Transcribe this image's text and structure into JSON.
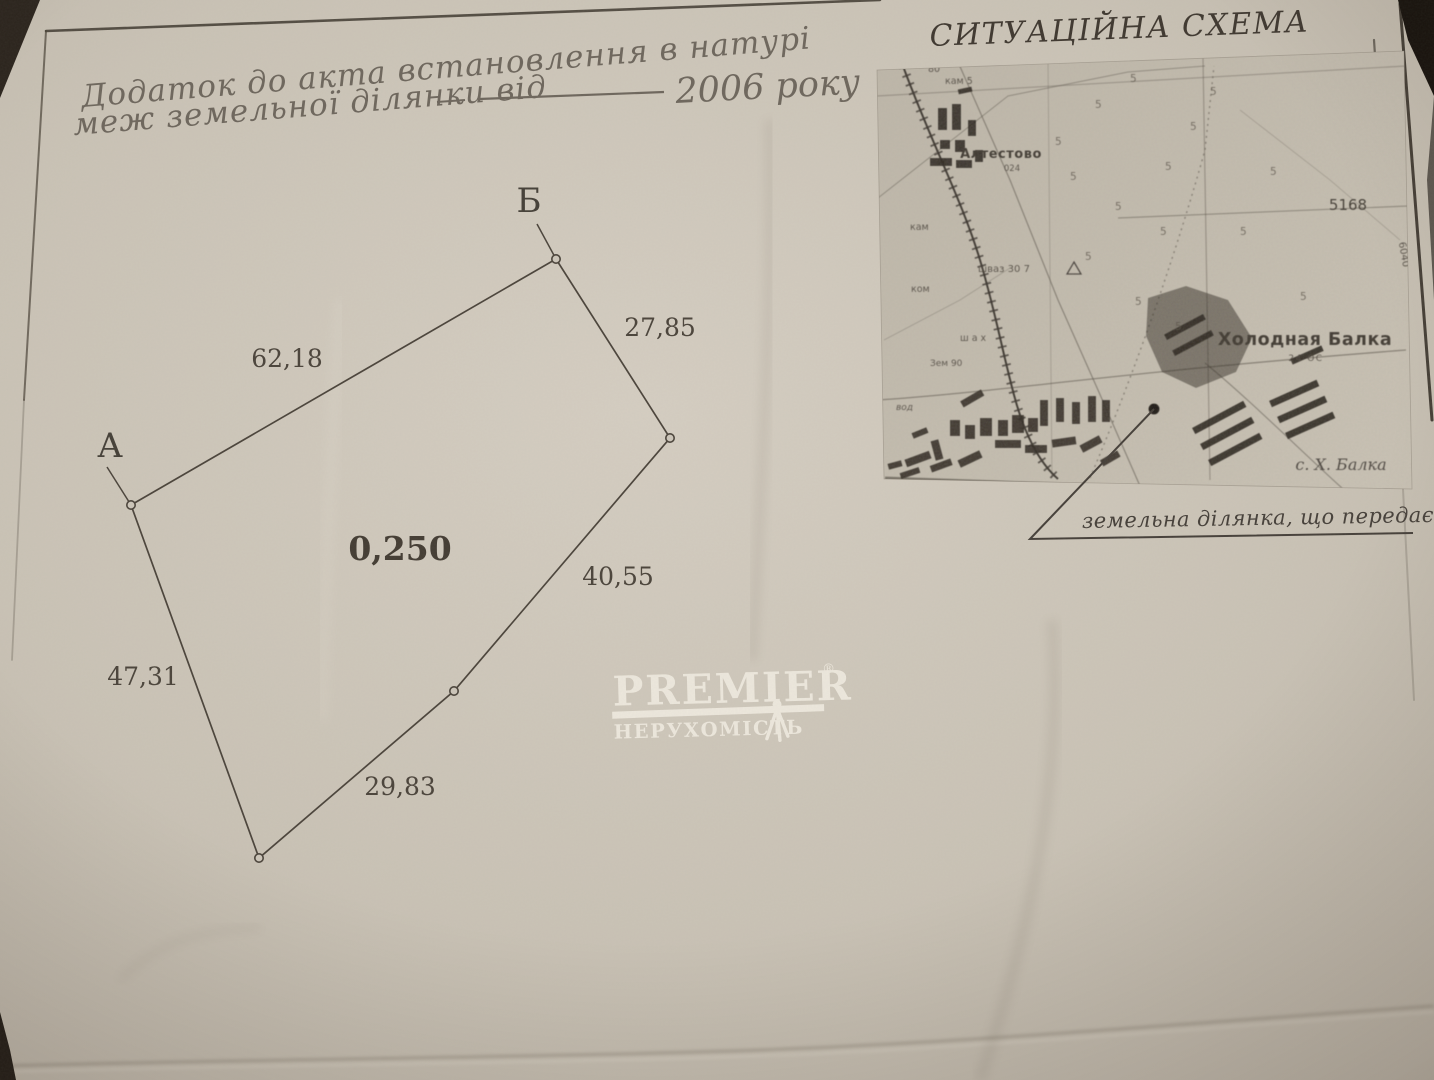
{
  "page": {
    "header_line1": "Додаток до акта встановлення в натурі",
    "header_line2": "меж земельної ділянки від",
    "header_year": "2006 року",
    "scheme_title": "СИТУАЦІЙНА СХЕМА",
    "map_caption": "земельна ділянка, що передається"
  },
  "plot": {
    "area_value": "0,250",
    "point_a_label": "А",
    "point_b_label": "Б",
    "side_ab": "62,18",
    "side_b1": "27,85",
    "side_12": "40,55",
    "side_23": "29,83",
    "side_3a": "47,31"
  },
  "map": {
    "settlement_1": "Алтестово",
    "settlement_1_note": "024",
    "settlement_2": "Холодная Балка",
    "settlement_2_note": "24 ОС",
    "village_note": "с. Х. Балка",
    "grid_code": "5168",
    "edge_code": "6040",
    "note_80": "80",
    "note_kam": "кам 5",
    "note_kam2": "кам",
    "note_kom": "ком",
    "note_zem": "Зем 90",
    "note_vod": "вод",
    "note_shah": "ш а х",
    "note_shvaz": "шваз 30 7",
    "tree_mark": "5"
  },
  "watermark": {
    "brand": "PREMIER",
    "registered": "®",
    "subtitle": "НЕРУХОМІСТЬ"
  },
  "colors": {
    "paper": "#cdc6ba",
    "ink": "#46403a",
    "header_ink": "#6e675d",
    "watermark": "#f1ece1",
    "background": "#14100c"
  }
}
